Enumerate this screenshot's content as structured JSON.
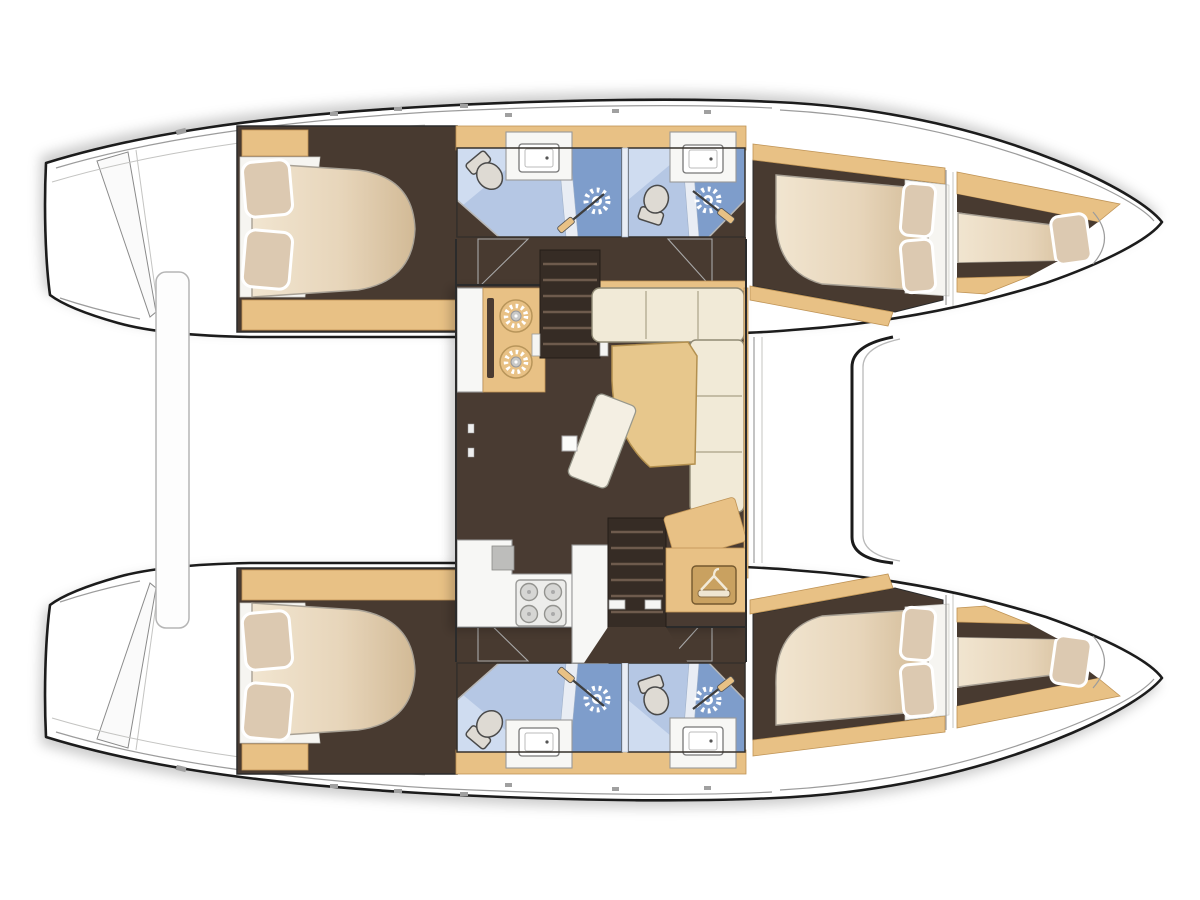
{
  "meta": {
    "title": "Catamaran yacht interior layout — top-down floor plan",
    "view": "top-down"
  },
  "colors": {
    "outline": "#1b1b1b",
    "hull_fill": "#ffffff",
    "deck_line": "#9c9c9c",
    "wood": "#e8c185",
    "wood_dark": "#bf9355",
    "floor_dark": "#483a30",
    "floor_darker": "#362c25",
    "step": "#6e5b4d",
    "mattress_light": "#f1e5d0",
    "mattress_mid": "#e7d5ba",
    "mattress_dark": "#d2ba96",
    "pillow": "#dcc9b1",
    "linen": "#f6f5f1",
    "bath_light": "#b5c7e4",
    "bath_pale": "#cfdcf0",
    "bath_dark": "#7e9dcb",
    "divider": "#e9edf4",
    "toilet": "#dedad3",
    "fixture_white": "#f7f7f5",
    "sofa": "#f1ead7",
    "table_wood": "#e7c78c",
    "appliance": "#ededeb",
    "burner_gray": "#d6d6d4"
  },
  "vessel": {
    "type": "catamaran",
    "hulls": [
      {
        "id": "port",
        "position": "top",
        "rooms": [
          "stern-platform",
          "aft-double-cabin",
          "aft-bathroom",
          "forward-bathroom",
          "forward-double-cabin",
          "bow-berth"
        ]
      },
      {
        "id": "starboard",
        "position": "bottom",
        "rooms": [
          "stern-platform",
          "aft-double-cabin",
          "aft-bathroom",
          "forward-bathroom",
          "forward-double-cabin",
          "bow-berth"
        ]
      }
    ],
    "salon": {
      "features": [
        "galley-island-two-burners",
        "companionway-stairs-port",
        "l-shaped-sofa",
        "dining-table",
        "movable-bench",
        "galley-counter-with-sink",
        "four-burner-hob",
        "companionway-stairs-starboard",
        "wardrobe"
      ]
    },
    "exterior": [
      "aft-cockpit-bench",
      "forward-crossbeam",
      "bow-points",
      "stern-steps"
    ]
  },
  "counts": {
    "double_cabins": 4,
    "bow_berths": 2,
    "bathrooms": 4,
    "toilets": 4,
    "showers": 4,
    "sinks_heads": 4,
    "galley_island_burners": 2,
    "hob_burners": 4
  },
  "icons": [
    "shower-sun-icon",
    "toilet-icon",
    "sink-icon",
    "burner-icon",
    "hanger-icon",
    "stairs-icon",
    "door-swing-icon",
    "pillow-icon",
    "bed-mattress"
  ]
}
